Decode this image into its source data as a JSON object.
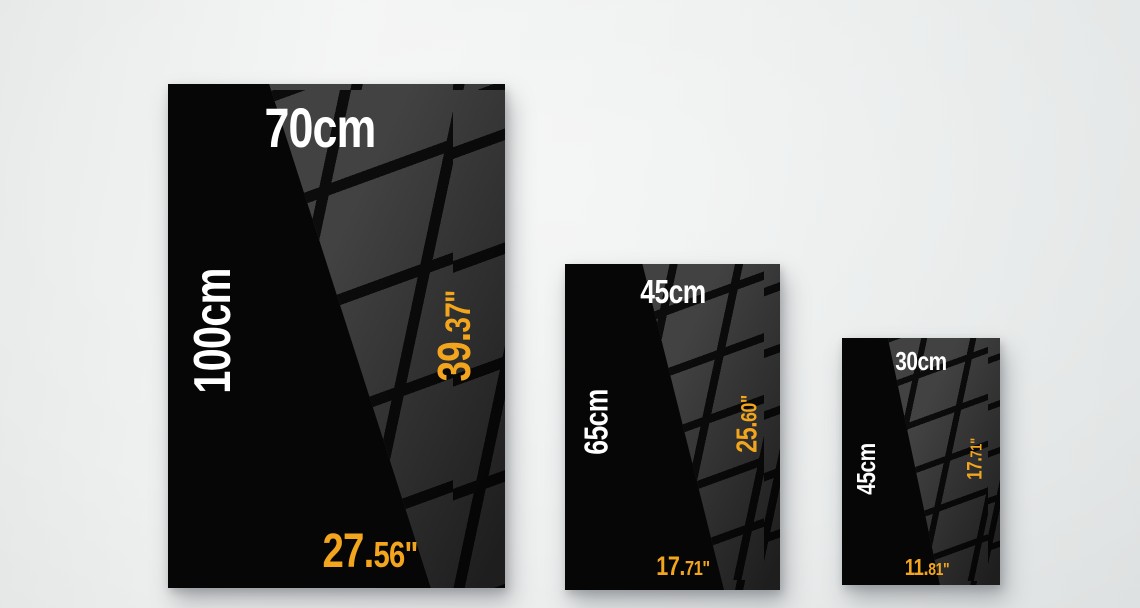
{
  "colors": {
    "poster_bg": "#060606",
    "reflection_square": "#424242",
    "reflection_gap": "#0c0c0c",
    "cm_text": "#ffffff",
    "inch_text": "#f2a51d",
    "wall": "#edefef"
  },
  "posters": [
    {
      "id": "large",
      "cm_width": "70cm",
      "cm_height": "100cm",
      "in_height_main": "39.",
      "in_height_frac": "37",
      "in_height_unit": "\"",
      "in_width_main": "27.",
      "in_width_frac": "56",
      "in_width_unit": "\""
    },
    {
      "id": "medium",
      "cm_width": "45cm",
      "cm_height": "65cm",
      "in_height_main": "25.",
      "in_height_frac": "60",
      "in_height_unit": "\"",
      "in_width_main": "17.",
      "in_width_frac": "71",
      "in_width_unit": "\""
    },
    {
      "id": "small",
      "cm_width": "30cm",
      "cm_height": "45cm",
      "in_height_main": "17.",
      "in_height_frac": "71",
      "in_height_unit": "\"",
      "in_width_main": "11.",
      "in_width_frac": "81",
      "in_width_unit": "\""
    }
  ]
}
